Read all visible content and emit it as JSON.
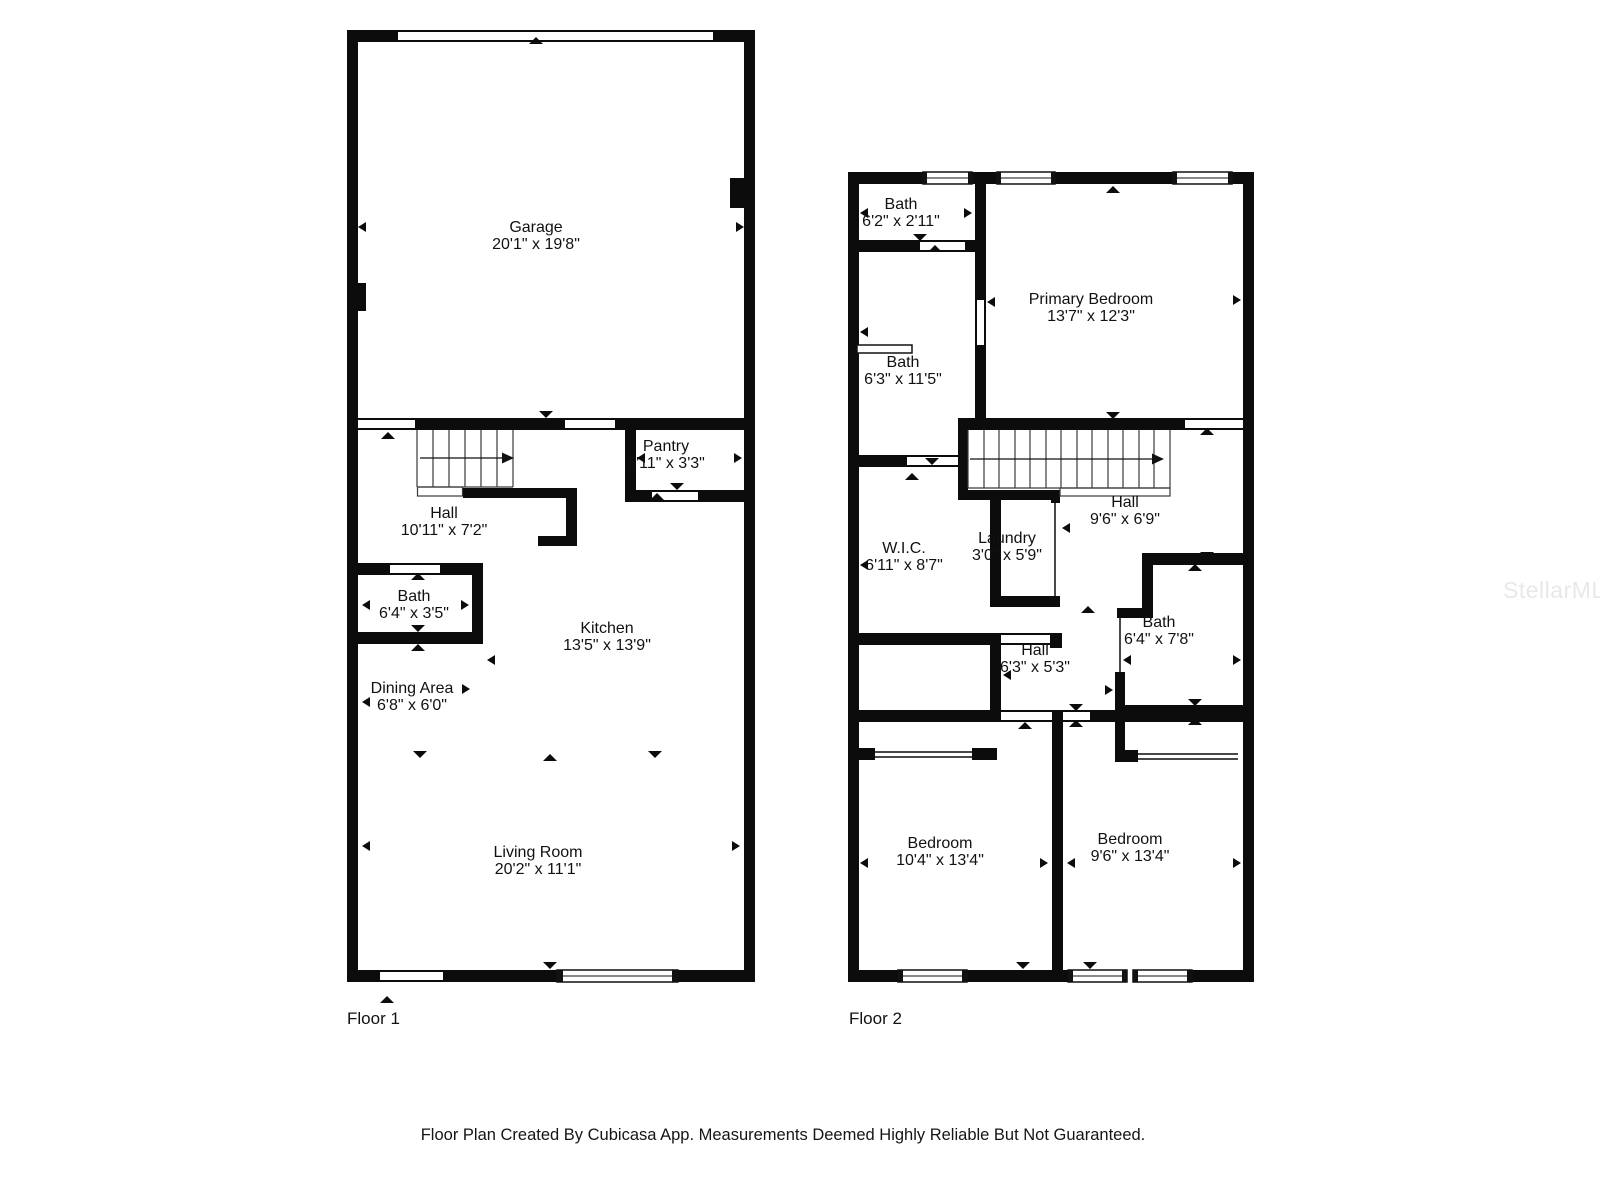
{
  "floor1": {
    "caption": "Floor 1",
    "rooms": {
      "garage": {
        "name": "Garage",
        "dims": "20'1\" x 19'8\""
      },
      "pantry": {
        "name": "Pantry",
        "dims": "5'11\" x 3'3\""
      },
      "hall": {
        "name": "Hall",
        "dims": "10'11\" x 7'2\""
      },
      "bath": {
        "name": "Bath",
        "dims": "6'4\" x 3'5\""
      },
      "kitchen": {
        "name": "Kitchen",
        "dims": "13'5\" x 13'9\""
      },
      "dining": {
        "name": "Dining Area",
        "dims": "6'8\" x 6'0\""
      },
      "living": {
        "name": "Living Room",
        "dims": "20'2\" x 11'1\""
      }
    }
  },
  "floor2": {
    "caption": "Floor 2",
    "rooms": {
      "bath_top": {
        "name": "Bath",
        "dims": "6'2\" x 2'11\""
      },
      "primary": {
        "name": "Primary Bedroom",
        "dims": "13'7\" x 12'3\""
      },
      "bath_left": {
        "name": "Bath",
        "dims": "6'3\" x 11'5\""
      },
      "hall_upper": {
        "name": "Hall",
        "dims": "9'6\" x 6'9\""
      },
      "wic": {
        "name": "W.I.C.",
        "dims": "6'11\" x 8'7\""
      },
      "laundry": {
        "name": "Laundry",
        "dims": "3'0\" x 5'9\""
      },
      "bath_right": {
        "name": "Bath",
        "dims": "6'4\" x 7'8\""
      },
      "hall_lower": {
        "name": "Hall",
        "dims": "6'3\" x 5'3\""
      },
      "bedroom_left": {
        "name": "Bedroom",
        "dims": "10'4\" x 13'4\""
      },
      "bedroom_right": {
        "name": "Bedroom",
        "dims": "9'6\" x 13'4\""
      }
    }
  },
  "footer": {
    "disclaimer": "Floor Plan Created By Cubicasa App. Measurements Deemed Highly Reliable But Not Guaranteed."
  },
  "watermark": {
    "text": "StellarMLS"
  }
}
